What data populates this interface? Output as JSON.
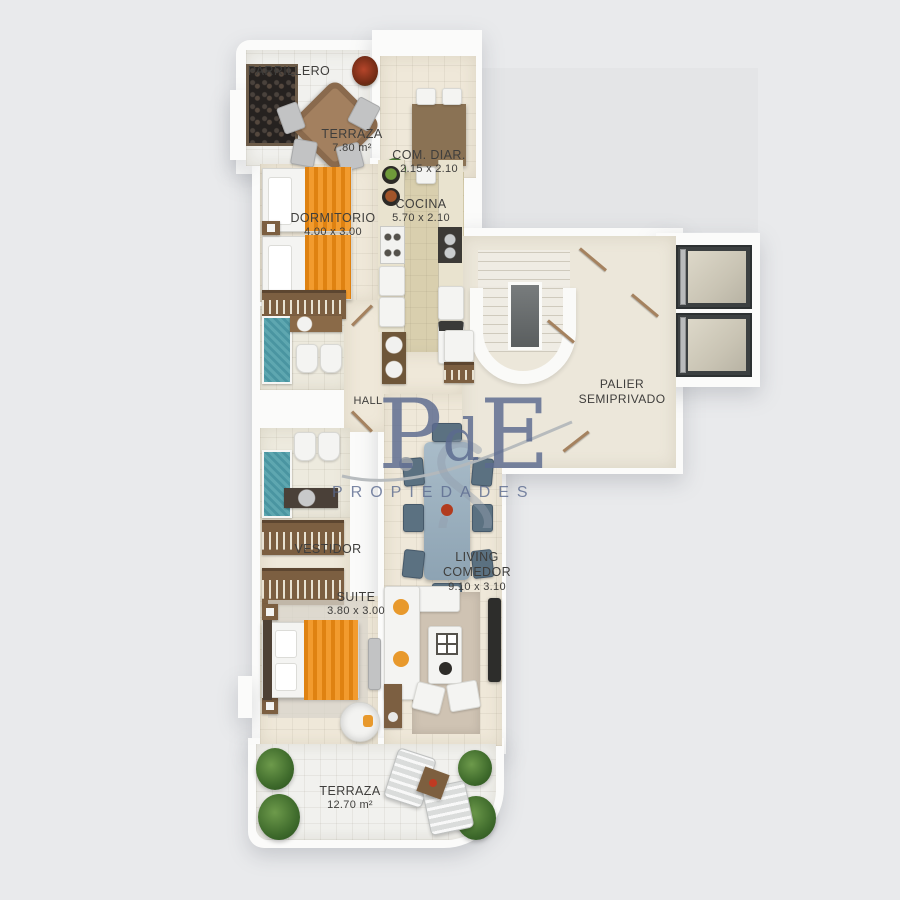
{
  "rooms": {
    "parrillero": {
      "name": "PARRILLERO"
    },
    "terraza_top": {
      "name": "TERRAZA",
      "area": "7.80 m²"
    },
    "com_diar": {
      "name": "COM. DIAR.",
      "dims": "2.15 x 2.10"
    },
    "cocina": {
      "name": "COCINA",
      "dims": "5.70 x 2.10"
    },
    "dormitorio": {
      "name": "DORMITORIO",
      "dims": "4.00 x 3.00"
    },
    "hall": {
      "name": "HALL"
    },
    "palier": {
      "line1": "PALIER",
      "line2": "SEMIPRIVADO"
    },
    "vestidor": {
      "name": "VESTIDOR"
    },
    "living": {
      "line1": "LIVING",
      "line2": "COMEDOR",
      "dims": "9.10 x 3.10"
    },
    "suite": {
      "name": "SUITE",
      "dims": "3.80 x 3.00"
    },
    "terraza_bottom": {
      "name": "TERRAZA",
      "area": "12.70 m²"
    }
  },
  "watermark": {
    "letter_p": "P",
    "letter_d": "d",
    "letter_e": "E",
    "sub": "PROPIEDADES",
    "color": "#5b6a8f"
  },
  "colors": {
    "background": "#e9eaec",
    "wall_white": "#fbfbfa",
    "floor_cream": "#efe8d9",
    "floor_kitchen_tan": "#d9cfae",
    "floor_terrace_tile": "#f1f1ee",
    "bed_orange": "#e8891c",
    "shower_teal": "#55a0ab",
    "wood_brown": "#7c5f41",
    "dining_chair_slate": "#5b7181",
    "elevator_dark": "#3c4041",
    "label_text": "#3f3e3c",
    "watermark_blue": "#5b6a8f"
  }
}
